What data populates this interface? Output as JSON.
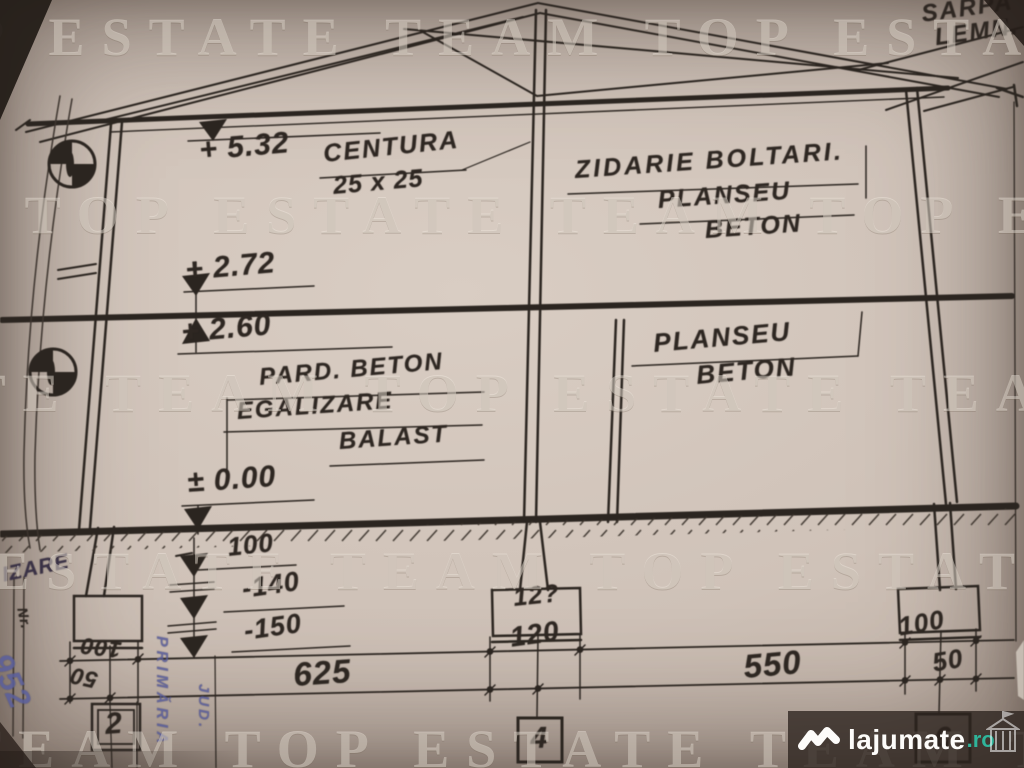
{
  "watermark": {
    "text": "TOP ESTATE TEAM",
    "tiled": "TOP ESTATE TEAM      TOP ESTATE TEAM      TOP ESTATE TEAM"
  },
  "logo": {
    "brand": "lajumate",
    "tld": ".ro",
    "accent_color": "#2fb49a"
  },
  "colors": {
    "paper": "#cfc3b9",
    "ink": "#2b2520",
    "stamp_blue": "#565b99"
  },
  "notes": {
    "roof_line1": "SARPA",
    "roof_line2": "LEMN.",
    "centura": "CENTURA",
    "centura_size": "25 x 25",
    "zidarie": "ZIDARIE BOLTARI.",
    "planseu_top1": "PLANSEU",
    "planseu_top2": "BETON",
    "pard_beton": "PARD. BETON",
    "egalizare": "EGALIZARE",
    "balast": "BALAST",
    "planseu_right1": "PLANSEU",
    "planseu_right2": "BETON"
  },
  "elevations": {
    "roof": "+ 5.32",
    "ceiling": "+ 2.72",
    "floor": "+ 2.60",
    "ground": "± 0.00",
    "minus100": "100",
    "minus140": "-140",
    "minus150": "-150"
  },
  "dimensions": {
    "span_left": "625",
    "span_right": "550",
    "opening_center": "120",
    "footing_center_label": "12?",
    "footing_left_width": "100",
    "footing_left_offset": "50",
    "footing_right_width": "100",
    "footing_right_offset": "50"
  },
  "axes": {
    "left": "2",
    "center": "4",
    "right": "6"
  },
  "stamp": {
    "fragment": "IZARE",
    "nr": "Nr.",
    "primaria": "PRIMĂRIA",
    "jud": "JUD.",
    "signature": "952"
  }
}
